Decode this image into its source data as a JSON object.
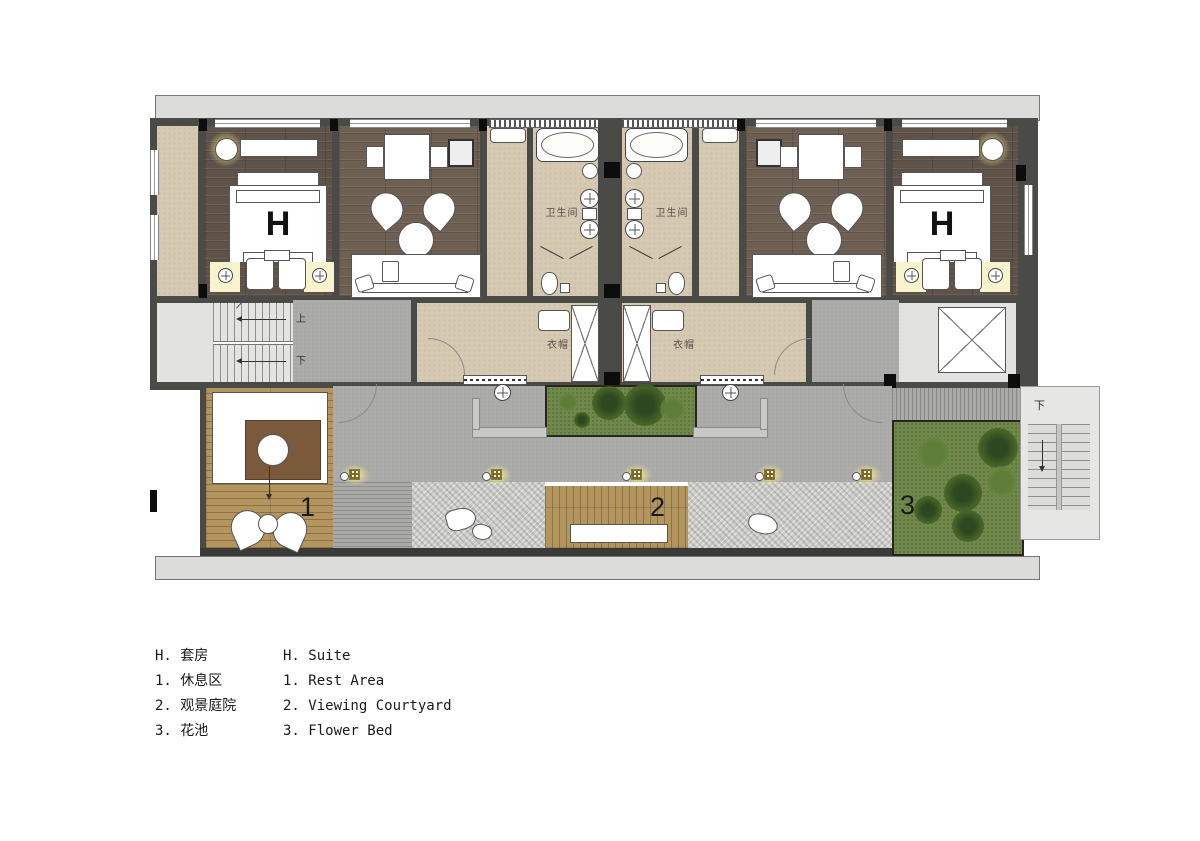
{
  "legend": {
    "rows": [
      {
        "zh": "H. 套房",
        "en": "H. Suite"
      },
      {
        "zh": "1. 休息区",
        "en": "1. Rest Area"
      },
      {
        "zh": "2. 观景庭院",
        "en": "2. Viewing Courtyard"
      },
      {
        "zh": "3. 花池",
        "en": "3. Flower Bed"
      }
    ]
  },
  "plan": {
    "rooms": {
      "bathroom_left": "卫生间",
      "bathroom_right": "卫生间",
      "wardrobe_left": "衣帽",
      "wardrobe_right": "衣帽"
    },
    "markers": {
      "suite_left": "H",
      "suite_right": "H",
      "rest_area": "1",
      "viewing_courtyard": "2",
      "flower_bed": "3"
    },
    "stairs": {
      "interior_up": "上",
      "interior_down": "下",
      "exterior_down": "下"
    },
    "colors": {
      "wall": "#4a4a47",
      "wood_floor": "#6e5f53",
      "bedroom_floor": "#5f5349",
      "tile_floor": "#d6c9b2",
      "terrace_paving": "#a9a9a7",
      "gravel": "#ccccc8",
      "deck_wood": "#b2955f",
      "lawn": "#70894b",
      "eave": "#dcdcda",
      "light_glow": "#f6ee8e",
      "stair_fill": "#e4e4e2"
    }
  }
}
